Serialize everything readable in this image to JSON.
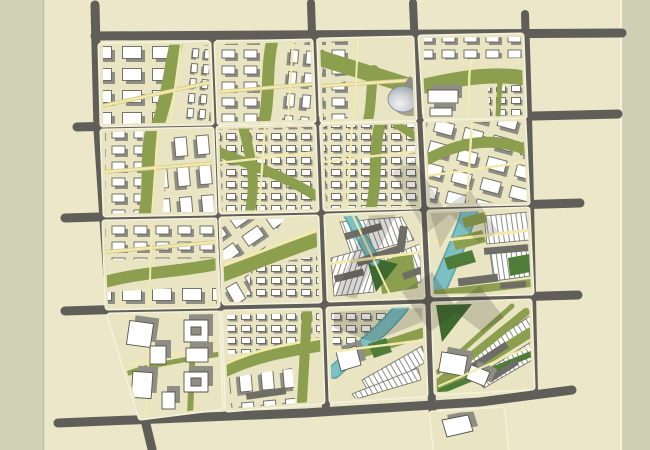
{
  "map": {
    "type": "urban-master-plan",
    "grid": {
      "rows": 4,
      "cols": 4
    },
    "palette": {
      "bg_main": "#ebe7c8",
      "margin_left": "#d0d2b6",
      "margin_right": "#ced1b4",
      "margin_line": "#bcbfa2",
      "road": "#5f5e58",
      "block_fill": "#e9e5c2",
      "block_rim": "#f5f2dc",
      "bldg_fill": "#ffffff",
      "bldg_stroke": "#56534c",
      "bldg_shadow": "#8f8e85",
      "slab": "#6e6d66",
      "green": "#8c9f4e",
      "green_dark": "#507c39",
      "green_deep": "#3e6a30",
      "water": "#7cc0c2",
      "water_edge": "#5aa3a8",
      "path_fill": "#f2eaae",
      "path_casing": "#d6ca8e",
      "dome_hi": "#f2f3f1",
      "dome_lo": "#97a0a9",
      "shadow": "#35342e"
    },
    "features": [
      {
        "name": "road-grid",
        "kind": "arterial roads, 5x5 lines with stub extensions"
      },
      {
        "name": "city-blocks",
        "kind": "16 rounded superblocks of building fields"
      },
      {
        "name": "green-corridors",
        "kind": "olive landscape bands weaving through blocks"
      },
      {
        "name": "water-canal",
        "kind": "teal canal and river in south-east blocks"
      },
      {
        "name": "dome-landmark",
        "kind": "domed civic building, north-central block"
      },
      {
        "name": "tower-shadows",
        "kind": "dark cast shadows over south-east quadrant"
      }
    ]
  }
}
